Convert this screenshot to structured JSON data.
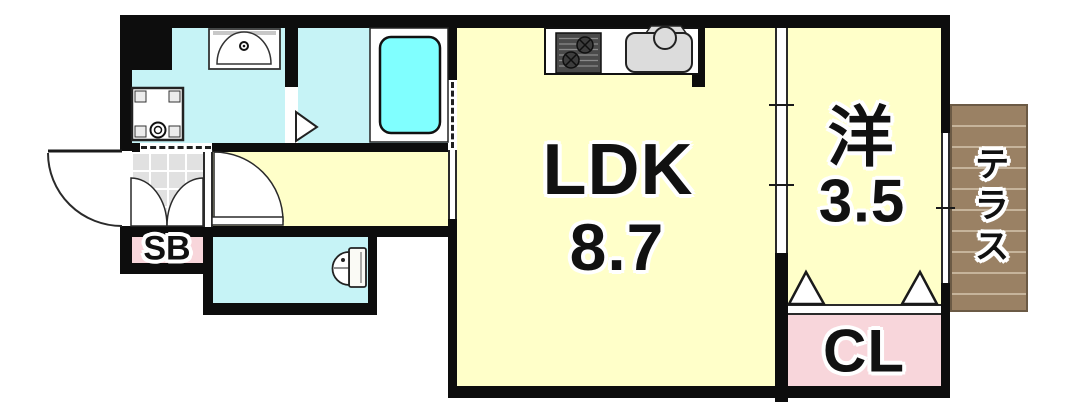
{
  "floorplan": {
    "rooms": {
      "ldk": {
        "label": "LDK",
        "area": "8.7",
        "floor_color": "#FFFFC9"
      },
      "western_room": {
        "label": "洋",
        "area": "3.5",
        "floor_color": "#FFFFC9"
      },
      "closet": {
        "label": "CL",
        "floor_color": "#F8D6DB"
      },
      "shoe_box": {
        "label": "SB",
        "floor_color": "#F8D6DB"
      },
      "terrace": {
        "label": "テラス",
        "floor_color": "#9A8164"
      },
      "bathroom": {
        "floor_color": "#C6F3F6"
      },
      "washroom": {
        "floor_color": "#C6F3F6"
      },
      "toilet_room": {
        "floor_color": "#C6F3F6"
      },
      "hallway": {
        "floor_color": "#FFFFC9"
      }
    },
    "palette": {
      "wall": "#0d0d0d",
      "bathtub": "#80FFFF",
      "entrance_tile": "#e1e1e1",
      "terrace_plank_line": "#C6B49B",
      "label_text": "#111111",
      "label_outline": "#ffffff"
    },
    "fixtures": [
      "bathtub",
      "washbasin",
      "washing-machine-pan",
      "kitchen-stove",
      "kitchen-sink",
      "toilet",
      "entrance-door",
      "closet-folding-door",
      "sliding-partition",
      "window"
    ]
  }
}
